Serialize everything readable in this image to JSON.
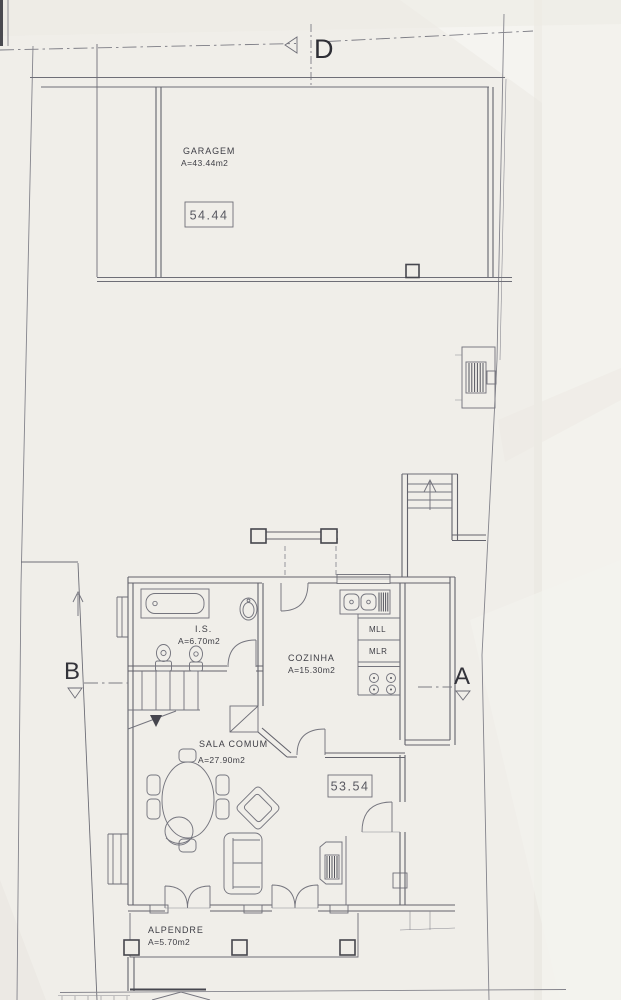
{
  "plan": {
    "type": "scanned architectural floor plan (ground floor)",
    "sections": {
      "d": "D",
      "b": "B",
      "a": "A"
    },
    "rooms": {
      "garagem": {
        "name": "GARAGEM",
        "area": "A=43.44m2",
        "level": "54.44"
      },
      "is": {
        "name": "I.S.",
        "area": "A=6.70m2"
      },
      "cozinha": {
        "name": "COZINHA",
        "area": "A=15.30m2"
      },
      "sala": {
        "name": "SALA COMUM",
        "area": "A=27.90m2",
        "level": "53.54"
      },
      "alpendre": {
        "name": "ALPENDRE",
        "area": "A=5.70m2"
      }
    },
    "appliances": {
      "mll": "MLL",
      "mlr": "MLR"
    },
    "icons": {
      "bathtub-icon": "plan-symbol bathtub",
      "washbasin-icon": "plan-symbol oval washbasin",
      "toilet-icon": "plan-symbol toilet",
      "bidet-icon": "plan-symbol bidet",
      "kitchen-sink-icon": "plan-symbol double sink with drainer",
      "stove-icon": "plan-symbol 4-burner hob",
      "dining-table-icon": "plan-symbol oval table with 6 chairs",
      "sofa-icon": "plan-symbol two-seat sofa",
      "armchair-icon": "plan-symbol rotated armchair",
      "tub-chair-icon": "plan-symbol round chair",
      "fireplace-icon": "plan-symbol hearth / tv unit with hatching",
      "stairs-icon": "plan-symbol interior stair with break line and down arrow",
      "exterior-steps-icon": "plan-symbol entry steps with up arrow",
      "gate-icon": "plan-symbol boundary gate / meter box with hatching",
      "column-icon": "plan-symbol square porch column",
      "section-cut-triangle": "plan-symbol section direction triangle"
    },
    "colors": {
      "paper": "#f0eee9",
      "wall_line": "#63636c",
      "boundary_line": "#84848c",
      "dark_accent": "#46464e",
      "text": "#3e3e45"
    }
  }
}
